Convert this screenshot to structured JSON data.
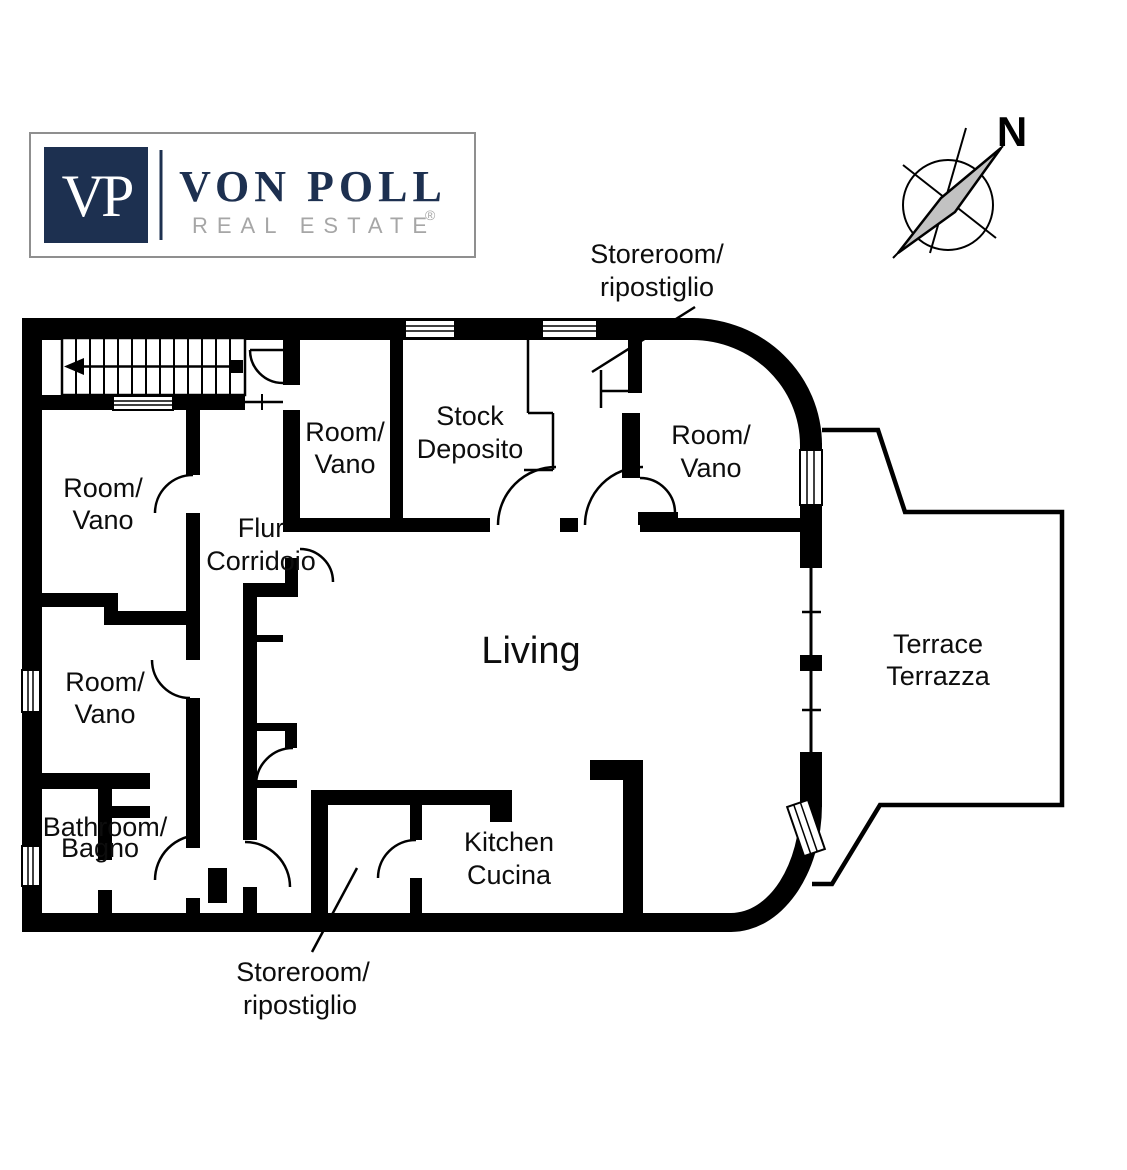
{
  "logo": {
    "monogram": "VP",
    "brand": "VON POLL",
    "tagline": "REAL ESTATE",
    "registered": "®"
  },
  "compass": {
    "north_label": "N"
  },
  "rooms": {
    "storeroom_top": {
      "line1": "Storeroom/",
      "line2": "ripostiglio"
    },
    "stock": {
      "line1": "Stock",
      "line2": "Deposito"
    },
    "room_top_middle": {
      "line1": "Room/",
      "line2": "Vano"
    },
    "room_top_right": {
      "line1": "Room/",
      "line2": "Vano"
    },
    "room_upper_left": {
      "line1": "Room/",
      "line2": "Vano"
    },
    "corridor": {
      "line1": "Flur",
      "line2": "Corridoio"
    },
    "room_lower_left": {
      "line1": "Room/",
      "line2": "Vano"
    },
    "bathroom": {
      "line1": "Bathroom/",
      "line2": "Bagno"
    },
    "living": {
      "line1": "Living"
    },
    "kitchen": {
      "line1": "Kitchen",
      "line2": "Cucina"
    },
    "terrace": {
      "line1": "Terrace",
      "line2": "Terrazza"
    },
    "storeroom_bottom": {
      "line1": "Storeroom/",
      "line2": "ripostiglio"
    }
  },
  "colors": {
    "wall": "#000000",
    "brand_navy": "#1d3050",
    "tagline_gray": "#a6a6a6",
    "logo_border_gray": "#8f8f8f",
    "needle_gray": "#c2c2c2"
  }
}
